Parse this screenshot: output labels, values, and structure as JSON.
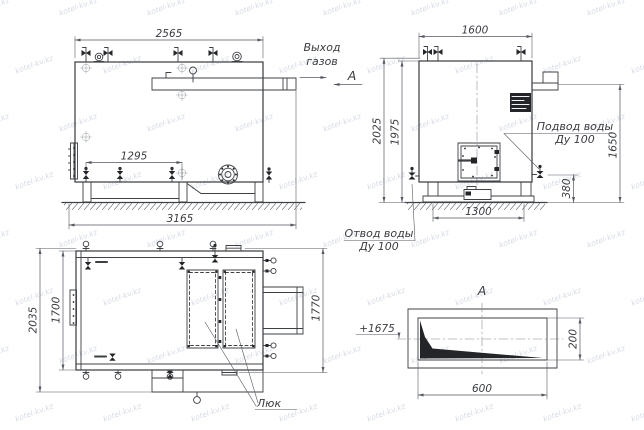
{
  "watermark": {
    "text": "kotel-kv.kz"
  },
  "side": {
    "dim_top": "2565",
    "dim_inner": "1295",
    "dim_overall": "3165"
  },
  "front": {
    "dim_top": "1600",
    "dim_left_outer": "2025",
    "dim_left_inner": "1975",
    "dim_right": "1650",
    "dim_right_lower": "380",
    "dim_bottom": "1300"
  },
  "plan": {
    "dim_left_outer": "2035",
    "dim_left_inner": "1700",
    "dim_right": "1770",
    "hatch_label": "Люк"
  },
  "section": {
    "title": "А",
    "dim_height": "200",
    "dim_width": "600",
    "level_mark": "+1675"
  },
  "labels": {
    "gas_outlet_line1": "Выход",
    "gas_outlet_line2": "газов",
    "section_mark": "А",
    "water_inlet_line1": "Подвод воды",
    "water_inlet_line2": "Ду 100",
    "water_outlet_line1": "Отвод воды",
    "water_outlet_line2": "Ду 100"
  }
}
